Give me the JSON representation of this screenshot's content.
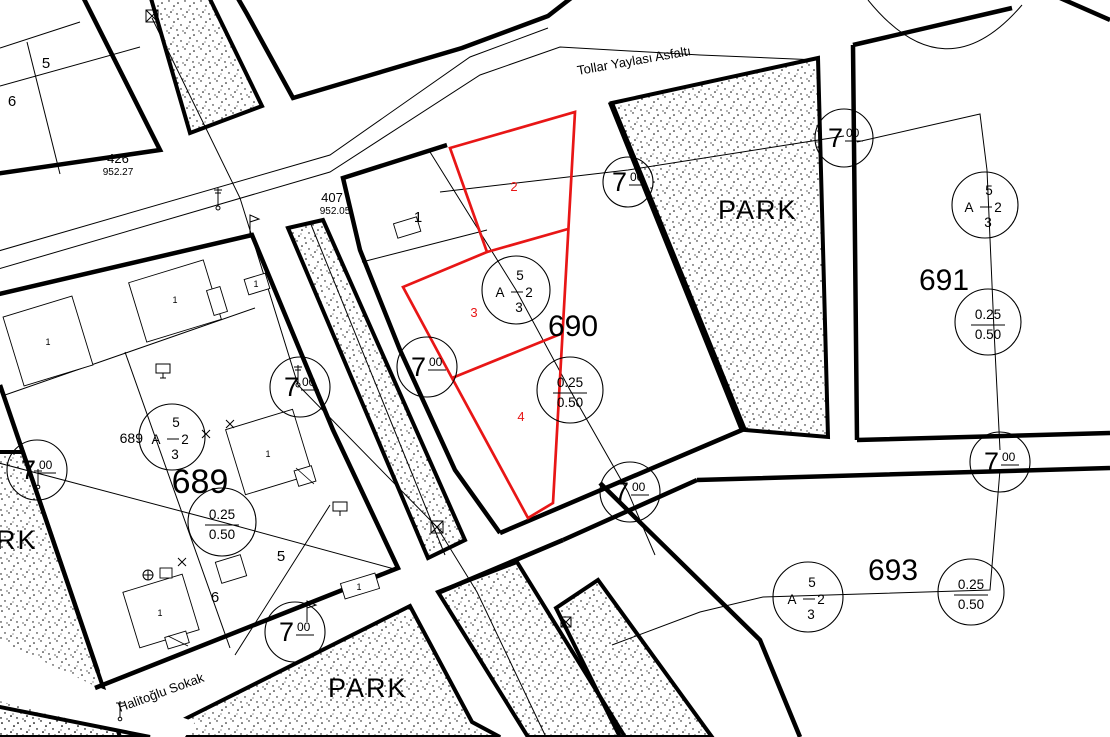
{
  "streets": {
    "tollar": "Tollar Yaylası Asfaltı",
    "halitoglu": "Halitoğlu Sokak"
  },
  "parks": {
    "top": "PARK",
    "bottom": "PARK",
    "left_partial": "RK"
  },
  "blocks": {
    "b426": {
      "no": "426",
      "elev": "952.27"
    },
    "b407": {
      "no": "407",
      "elev": "952.05"
    },
    "b689": {
      "no": "689"
    },
    "b690": {
      "no": "690"
    },
    "b691": {
      "no": "691"
    },
    "b693": {
      "no": "693"
    },
    "b689_ref": "689"
  },
  "parcels": {
    "red": {
      "p2": "2",
      "p3": "3",
      "p4": "4"
    },
    "p1": "1",
    "b426_p5": "5",
    "b426_p6": "6",
    "b689_p5": "5",
    "b689_p6": "6",
    "building": "1"
  },
  "markers": {
    "zoning": {
      "front_setback": "5",
      "nizam": "A",
      "storeys": "2",
      "side_setback": "3"
    },
    "ratio": {
      "taks": "0.25",
      "kaks": "0.50"
    },
    "road": {
      "num": "7",
      "width_sup": "00"
    }
  },
  "colors": {
    "line": "#000000",
    "red": "#e81616",
    "background": "#ffffff"
  }
}
